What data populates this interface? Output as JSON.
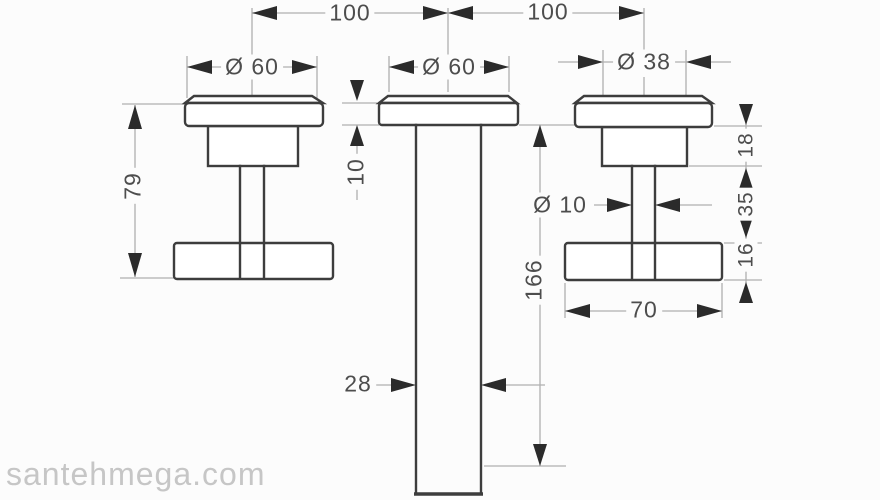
{
  "labels": {
    "top_left_spacing": "100",
    "top_right_spacing": "100",
    "left_handle_diameter": "Ø 60",
    "spout_plate_diameter": "Ø 60",
    "right_handle_diameter": "Ø 38",
    "handle_height": "79",
    "plate_thickness": "10",
    "spout_drop": "166",
    "stem_diameter": "Ø 10",
    "spout_width": "28",
    "crossbar_length": "70",
    "plate_to_body": "18",
    "body_to_bar": "35",
    "bar_thickness": "16"
  },
  "watermark": {
    "text": "santehmega.com"
  },
  "colors": {
    "line_dark": "#3d3d3d",
    "line_light": "#b0b0b0",
    "arrow_fill": "#2b2b2b",
    "label_text": "#4d4d4d",
    "watermark_text": "#c6c6c6",
    "background": "#fcfcfc"
  }
}
